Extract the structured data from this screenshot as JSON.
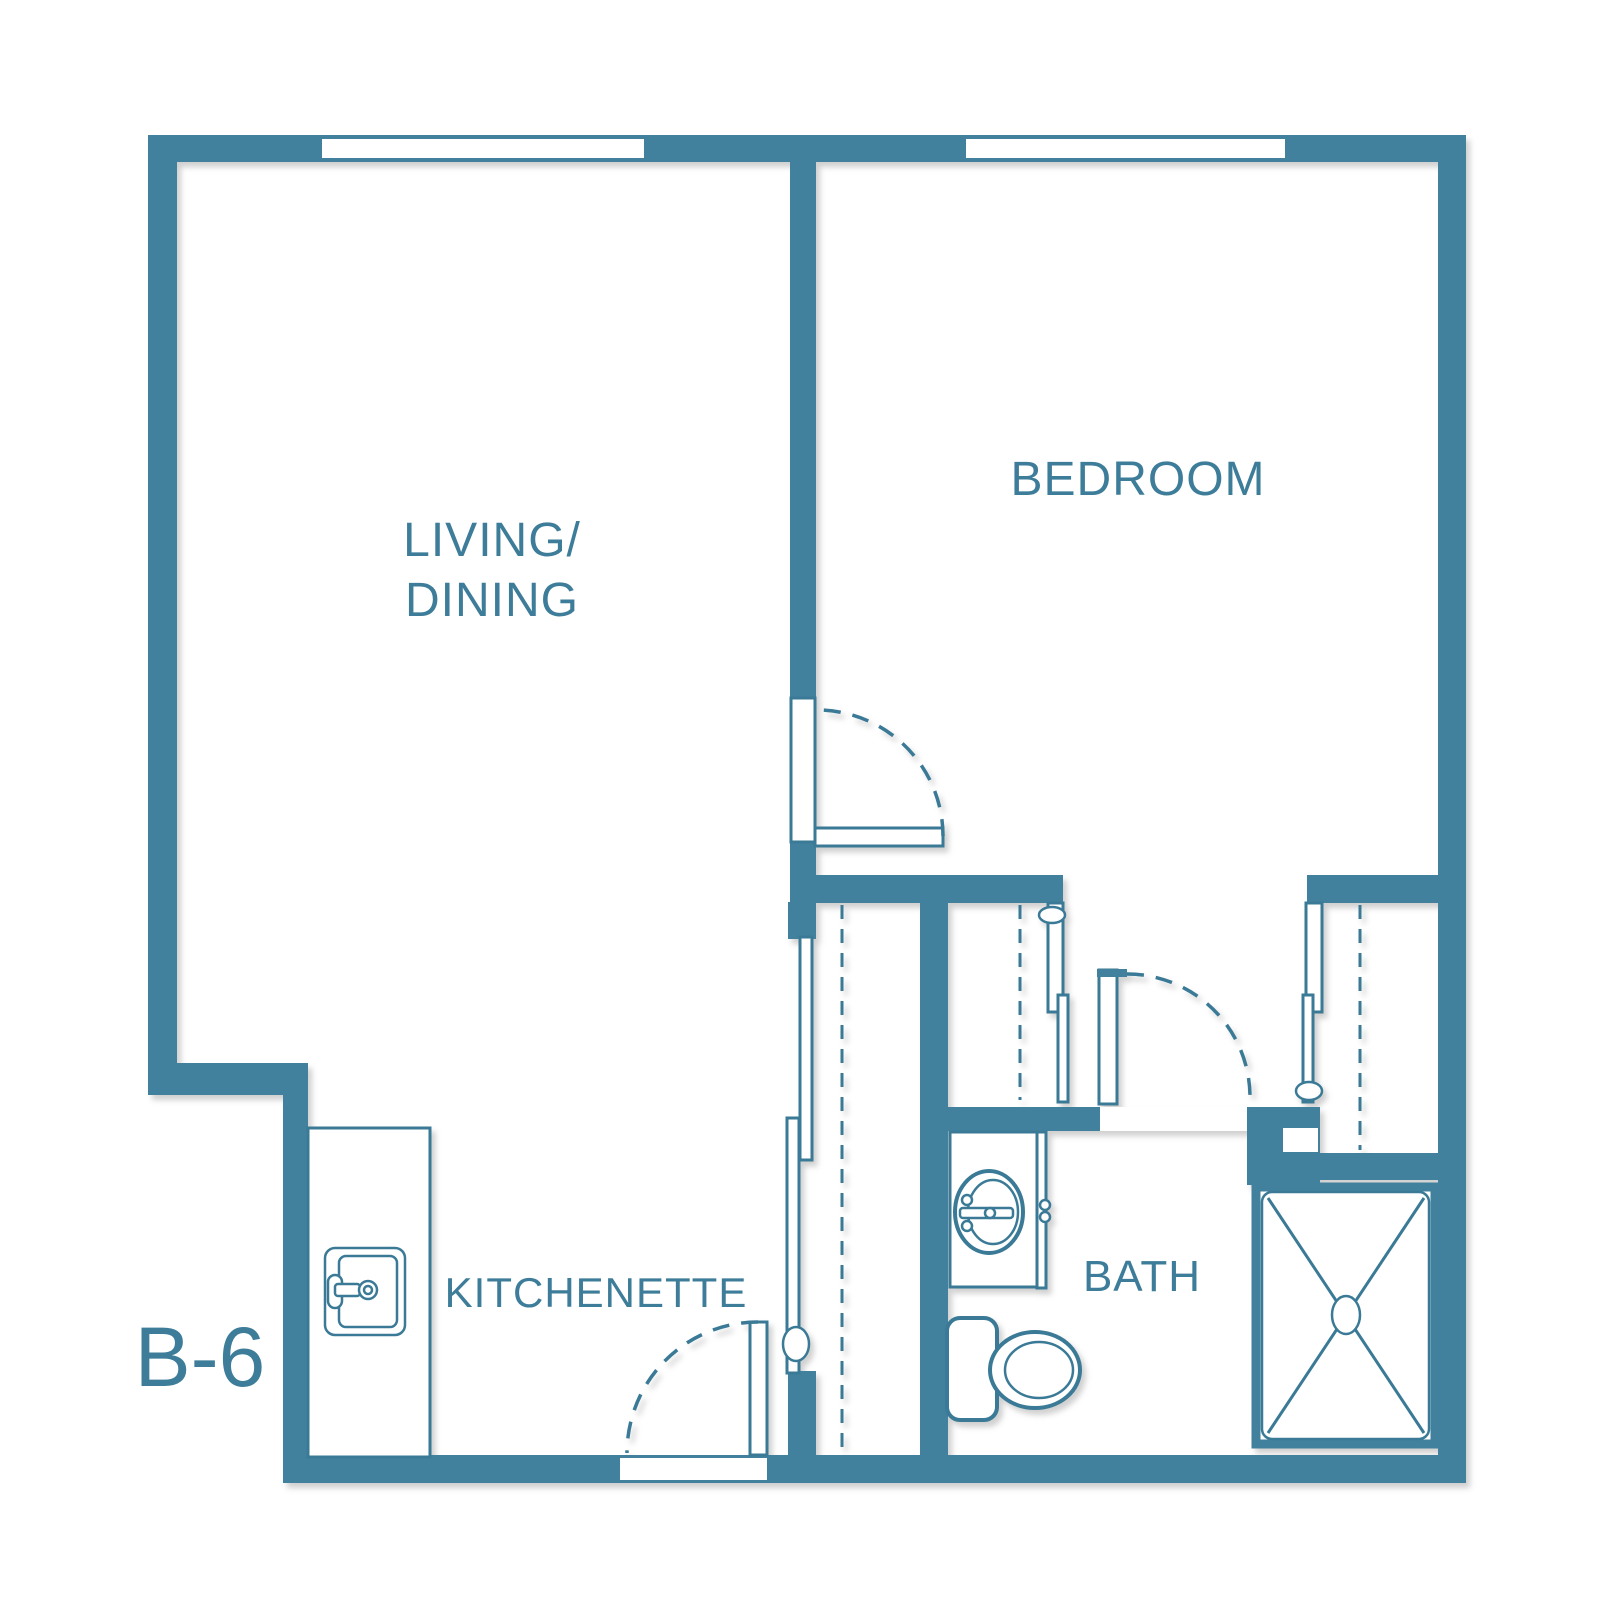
{
  "title": "B-6 unit floor plan",
  "colors": {
    "wall": "#41819E",
    "line": "#3A7A96",
    "text": "#3E7D9A",
    "background": "#FFFFFF"
  },
  "labels": {
    "living_line1": {
      "text": "LIVING/"
    },
    "living_line2": {
      "text": "DINING"
    },
    "bedroom": {
      "text": "BEDROOM"
    },
    "kitchenette": {
      "text": "KITCHENETTE"
    },
    "bath": {
      "text": "BATH"
    },
    "unit": {
      "text": "B-6"
    }
  },
  "plan": {
    "width": 1600,
    "height": 1622,
    "shapes": [
      {
        "t": "rect",
        "cls": "wall",
        "name": "top-wall",
        "x": 148,
        "y": 135,
        "w": 1318,
        "h": 27
      },
      {
        "t": "rect",
        "cls": "wall",
        "name": "left-wall",
        "x": 148,
        "y": 162,
        "w": 29,
        "h": 901
      },
      {
        "t": "rect",
        "cls": "wall",
        "name": "step-wall",
        "x": 148,
        "y": 1063,
        "w": 160,
        "h": 32
      },
      {
        "t": "rect",
        "cls": "wall",
        "name": "lower-left-wall",
        "x": 283,
        "y": 1095,
        "w": 25,
        "h": 365
      },
      {
        "t": "rect",
        "cls": "wall",
        "name": "bottom-wall",
        "x": 283,
        "y": 1455,
        "w": 1183,
        "h": 28
      },
      {
        "t": "rect",
        "cls": "wall",
        "name": "right-wall",
        "x": 1438,
        "y": 162,
        "w": 28,
        "h": 1296
      },
      {
        "t": "rect",
        "cls": "wall",
        "name": "bedroom-wall-upper",
        "x": 790,
        "y": 162,
        "w": 26,
        "h": 537
      },
      {
        "t": "rect",
        "cls": "wall",
        "name": "bedroom-wall-lower",
        "x": 790,
        "y": 843,
        "w": 26,
        "h": 59
      },
      {
        "t": "rect",
        "cls": "wall",
        "name": "hall-wall-left",
        "x": 790,
        "y": 875,
        "w": 273,
        "h": 28
      },
      {
        "t": "rect",
        "cls": "wall",
        "name": "hall-wall-right",
        "x": 1307,
        "y": 875,
        "w": 131,
        "h": 28
      },
      {
        "t": "rect",
        "cls": "wall",
        "name": "central-wall",
        "x": 920,
        "y": 875,
        "w": 28,
        "h": 582
      },
      {
        "t": "rect",
        "cls": "wall",
        "name": "closet-column-top",
        "x": 788,
        "y": 902,
        "w": 28,
        "h": 37
      },
      {
        "t": "rect",
        "cls": "wall",
        "name": "closet-column-bottom",
        "x": 788,
        "y": 1371,
        "w": 28,
        "h": 86
      },
      {
        "t": "rect",
        "cls": "wall",
        "name": "bath-wall",
        "x": 945,
        "y": 1107,
        "w": 160,
        "h": 24
      },
      {
        "t": "rect",
        "cls": "wall",
        "name": "bath-door-block",
        "x": 1247,
        "y": 1107,
        "w": 73,
        "h": 78
      },
      {
        "t": "rect",
        "cls": "wall",
        "name": "closet-wall-right",
        "x": 1320,
        "y": 1153,
        "w": 118,
        "h": 27
      },
      {
        "t": "rect",
        "cls": "white",
        "name": "living-window",
        "x": 322,
        "y": 139,
        "w": 322,
        "h": 19
      },
      {
        "t": "rect",
        "cls": "white",
        "name": "bedroom-window",
        "x": 966,
        "y": 139,
        "w": 319,
        "h": 19
      },
      {
        "t": "rect",
        "cls": "white",
        "name": "entry-door-sill",
        "x": 620,
        "y": 1458,
        "w": 147,
        "h": 22
      },
      {
        "t": "rect",
        "cls": "white",
        "name": "bath-door-sill",
        "x": 1100,
        "y": 1107,
        "w": 147,
        "h": 24
      },
      {
        "t": "rect",
        "cls": "white",
        "name": "block-notch",
        "x": 1283,
        "y": 1128,
        "w": 35,
        "h": 24
      },
      {
        "t": "rect",
        "cls": "panel",
        "name": "bedroom-door-jamb",
        "x": 791,
        "y": 698,
        "w": 24,
        "h": 144
      },
      {
        "t": "rect",
        "cls": "panel",
        "name": "bedroom-door-leaf",
        "x": 815,
        "y": 828,
        "w": 128,
        "h": 18
      },
      {
        "t": "path",
        "cls": "swing",
        "name": "bedroom-door-swing",
        "d": "M 943 836 A 126 126 0 0 0 817 710"
      },
      {
        "t": "rect",
        "cls": "panel",
        "name": "entry-door-leaf",
        "x": 750,
        "y": 1322,
        "w": 17,
        "h": 133
      },
      {
        "t": "path",
        "cls": "swing",
        "name": "entry-door-swing",
        "d": "M 758 1322 A 131 131 0 0 0 627 1453"
      },
      {
        "t": "rect",
        "cls": "panel",
        "name": "bath-door-leaf",
        "x": 1099,
        "y": 970,
        "w": 18,
        "h": 134
      },
      {
        "t": "rect",
        "cls": "wall",
        "name": "bath-door-hinge-tick",
        "x": 1097,
        "y": 969,
        "w": 30,
        "h": 8
      },
      {
        "t": "path",
        "cls": "swing",
        "name": "bath-door-swing",
        "d": "M 1127 974 A 123 123 0 0 1 1250 1097"
      },
      {
        "t": "rect",
        "cls": "panel",
        "name": "hall-closet-door-a",
        "x": 800,
        "y": 937,
        "w": 12,
        "h": 223
      },
      {
        "t": "rect",
        "cls": "panel",
        "name": "hall-closet-door-b",
        "x": 787,
        "y": 1118,
        "w": 12,
        "h": 255
      },
      {
        "t": "ellipse",
        "cls": "thin",
        "name": "hall-closet-handle",
        "cx": 796,
        "cy": 1344,
        "rx": 13,
        "ry": 17
      },
      {
        "t": "rect",
        "cls": "panel",
        "name": "left-closet-door-a",
        "x": 1048,
        "y": 903,
        "w": 15,
        "h": 109
      },
      {
        "t": "rect",
        "cls": "panel",
        "name": "left-closet-door-b",
        "x": 1058,
        "y": 995,
        "w": 10,
        "h": 107
      },
      {
        "t": "ellipse",
        "cls": "thin",
        "name": "left-closet-handle",
        "cx": 1052,
        "cy": 915,
        "rx": 13,
        "ry": 8
      },
      {
        "t": "rect",
        "cls": "panel",
        "name": "right-closet-door-a",
        "x": 1306,
        "y": 903,
        "w": 16,
        "h": 109
      },
      {
        "t": "rect",
        "cls": "panel",
        "name": "right-closet-door-b",
        "x": 1303,
        "y": 995,
        "w": 10,
        "h": 107
      },
      {
        "t": "ellipse",
        "cls": "thin",
        "name": "right-closet-handle",
        "cx": 1309,
        "cy": 1091,
        "rx": 13,
        "ry": 9
      },
      {
        "t": "line",
        "cls": "rod",
        "name": "hall-closet-rod",
        "x1": 842,
        "y1": 905,
        "x2": 842,
        "y2": 1448
      },
      {
        "t": "line",
        "cls": "rod",
        "name": "left-closet-rod",
        "x1": 1020,
        "y1": 905,
        "x2": 1020,
        "y2": 1100
      },
      {
        "t": "line",
        "cls": "rod",
        "name": "right-closet-rod",
        "x1": 1360,
        "y1": 905,
        "x2": 1360,
        "y2": 1150
      },
      {
        "t": "rect",
        "cls": "panel",
        "name": "kitchen-counter",
        "x": 308,
        "y": 1128,
        "w": 122,
        "h": 329
      },
      {
        "t": "rect",
        "cls": "thin",
        "name": "kitchen-sink",
        "x": 325,
        "y": 1248,
        "w": 80,
        "h": 87,
        "rx": 10
      },
      {
        "t": "rect",
        "cls": "thin",
        "name": "kitchen-sink-basin",
        "x": 339,
        "y": 1256,
        "w": 58,
        "h": 71,
        "rx": 7
      },
      {
        "t": "rect",
        "cls": "thin",
        "name": "kitchen-faucet-handle",
        "x": 328,
        "y": 1275,
        "w": 14,
        "h": 33,
        "rx": 7
      },
      {
        "t": "rect",
        "cls": "thin",
        "name": "kitchen-faucet-spout",
        "x": 335,
        "y": 1284,
        "w": 25,
        "h": 12,
        "rx": 3
      },
      {
        "t": "ellipse",
        "cls": "thin",
        "name": "kitchen-faucet-ring",
        "cx": 368,
        "cy": 1290,
        "rx": 9,
        "ry": 9
      },
      {
        "t": "ellipse",
        "cls": "thin",
        "name": "kitchen-faucet-dot",
        "cx": 368,
        "cy": 1290,
        "rx": 4,
        "ry": 4
      },
      {
        "t": "rect",
        "cls": "panel",
        "name": "vanity",
        "x": 950,
        "y": 1132,
        "w": 87,
        "h": 155
      },
      {
        "t": "rect",
        "cls": "panel",
        "name": "vanity-side-panel",
        "x": 1037,
        "y": 1132,
        "w": 9,
        "h": 156
      },
      {
        "t": "ellipse",
        "cls": "thin2",
        "name": "vanity-sink",
        "cx": 989,
        "cy": 1212,
        "rx": 34,
        "ry": 41
      },
      {
        "t": "ellipse",
        "cls": "thin",
        "name": "vanity-sink-basin",
        "cx": 993,
        "cy": 1212,
        "rx": 25,
        "ry": 32
      },
      {
        "t": "rect",
        "cls": "thin",
        "name": "vanity-faucet-bar",
        "x": 960,
        "y": 1208,
        "w": 53,
        "h": 10,
        "rx": 3
      },
      {
        "t": "ellipse",
        "cls": "thin",
        "name": "vanity-faucet-dot",
        "cx": 990,
        "cy": 1213,
        "rx": 5,
        "ry": 5
      },
      {
        "t": "ellipse",
        "cls": "thin",
        "name": "vanity-knob-top",
        "cx": 967,
        "cy": 1200,
        "rx": 5,
        "ry": 5
      },
      {
        "t": "ellipse",
        "cls": "thin",
        "name": "vanity-knob-bottom",
        "cx": 967,
        "cy": 1226,
        "rx": 5,
        "ry": 5
      },
      {
        "t": "ellipse",
        "cls": "thin",
        "name": "vanity-hinge-top",
        "cx": 1045,
        "cy": 1205,
        "rx": 5,
        "ry": 5
      },
      {
        "t": "ellipse",
        "cls": "thin",
        "name": "vanity-hinge-bottom",
        "cx": 1045,
        "cy": 1217,
        "rx": 5,
        "ry": 5
      },
      {
        "t": "rect",
        "cls": "thin2",
        "name": "toilet-tank",
        "x": 947,
        "y": 1318,
        "w": 50,
        "h": 102,
        "rx": 13
      },
      {
        "t": "ellipse",
        "cls": "thin2",
        "name": "toilet-bowl",
        "cx": 1035,
        "cy": 1370,
        "rx": 45,
        "ry": 38
      },
      {
        "t": "ellipse",
        "cls": "thin",
        "name": "toilet-seat",
        "cx": 1039,
        "cy": 1370,
        "rx": 34,
        "ry": 28
      },
      {
        "t": "rect",
        "cls": "shower-border",
        "name": "shower-frame",
        "x": 1256,
        "y": 1187,
        "w": 179,
        "h": 257
      },
      {
        "t": "rect",
        "cls": "thin",
        "name": "shower-pan",
        "x": 1262,
        "y": 1192,
        "w": 167,
        "h": 247,
        "rx": 10
      },
      {
        "t": "line",
        "cls": "xline",
        "name": "shower-diagonal-1",
        "x1": 1268,
        "y1": 1198,
        "x2": 1424,
        "y2": 1433
      },
      {
        "t": "line",
        "cls": "xline",
        "name": "shower-diagonal-2",
        "x1": 1424,
        "y1": 1198,
        "x2": 1268,
        "y2": 1433
      },
      {
        "t": "ellipse",
        "cls": "thin",
        "name": "shower-drain",
        "cx": 1346,
        "cy": 1315,
        "rx": 14,
        "ry": 19
      }
    ]
  }
}
